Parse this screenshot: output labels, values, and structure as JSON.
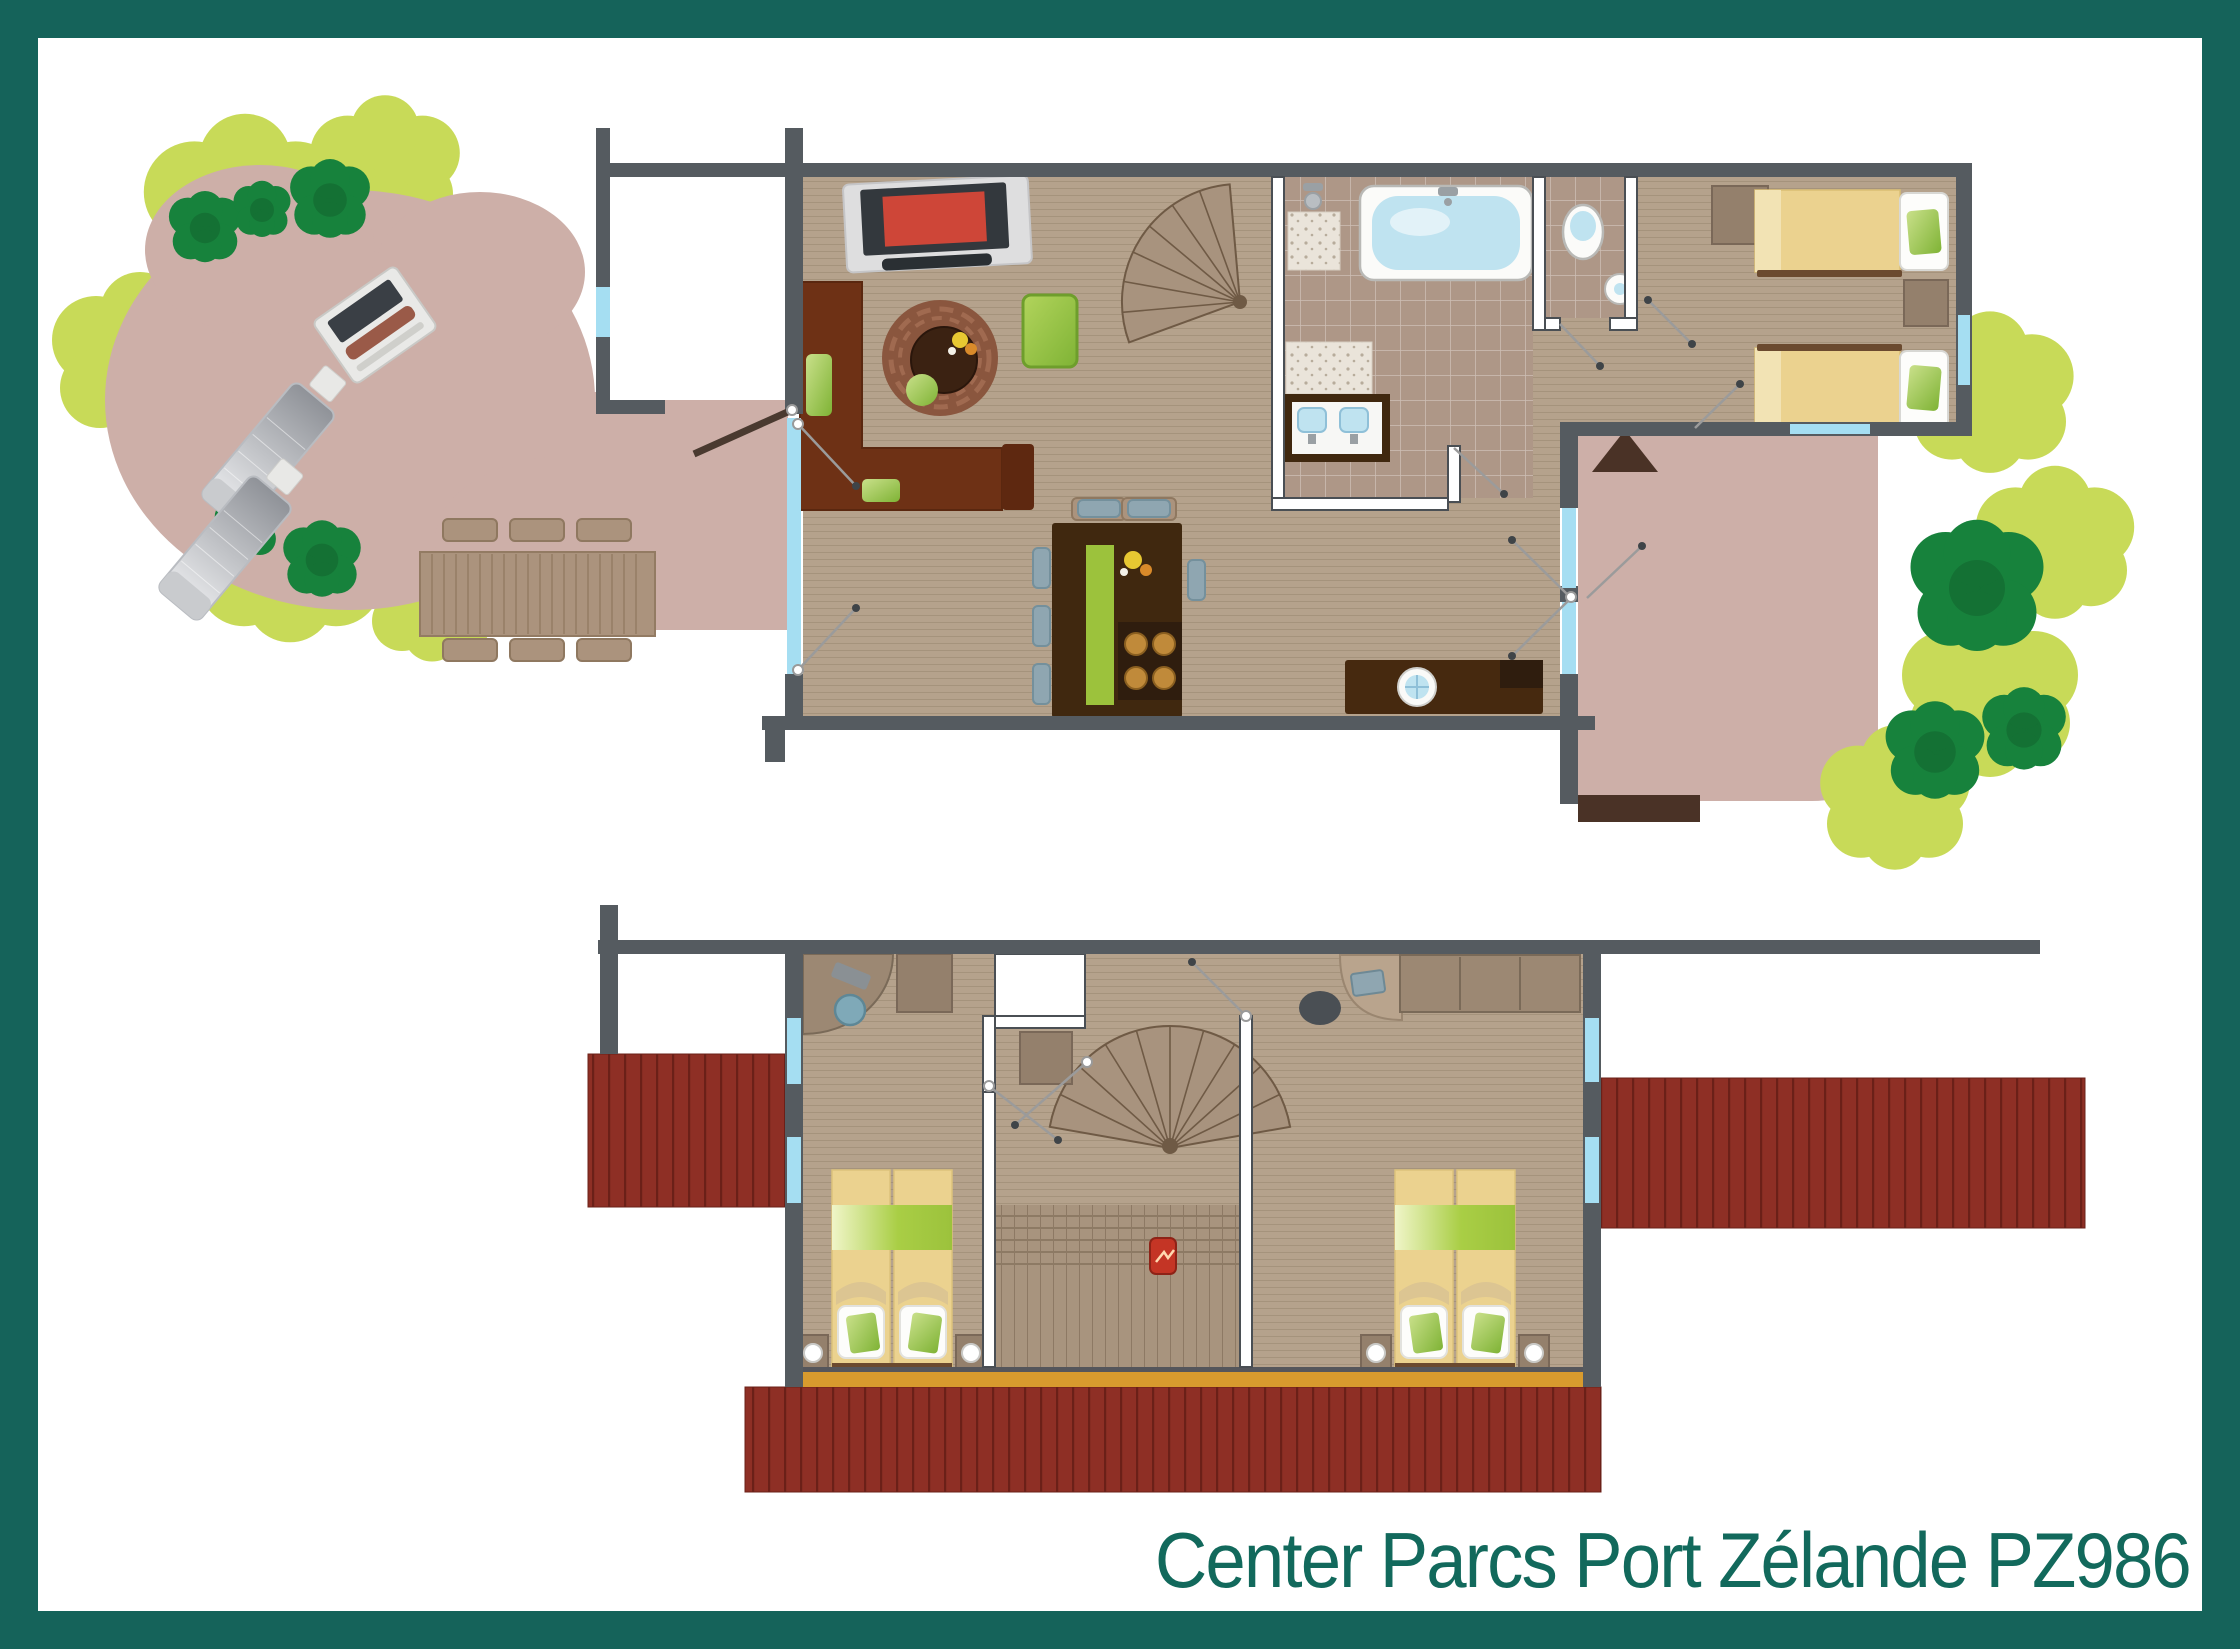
{
  "title": "Center Parcs Port Zélande PZ986",
  "palette": {
    "frame_teal": "#15635A",
    "title_teal": "#12695C",
    "wall_gray": "#555B60",
    "partition_outline": "#4A4F54",
    "window_blue": "#A5DEF2",
    "floor_wood": "#B5A28C",
    "bathroom_tile": "#AE9787",
    "terrace_pink": "#CDAFA8",
    "deck_red": "#8E2F25",
    "tree_green": "#17823C",
    "bush_green": "#C8DA58",
    "accent_green": "#9CC23C",
    "bed_yellow": "#EBD28F",
    "sofa_brown": "#6E3115",
    "kitchen_brown": "#40280F",
    "sill_orange": "#D89B2E"
  },
  "icons": {
    "bathtub": "bathtub-icon",
    "toilet": "toilet-icon",
    "shower": "shower-icon",
    "washbasin": "washbasin-icon",
    "cooktop": "cooktop-icon",
    "fire_extinguisher": "fire-extinguisher-icon",
    "spiral_stairs": "spiral-stairs-icon",
    "bbq": "bbq-icon",
    "north_arrow": "direction-triangle-icon"
  }
}
